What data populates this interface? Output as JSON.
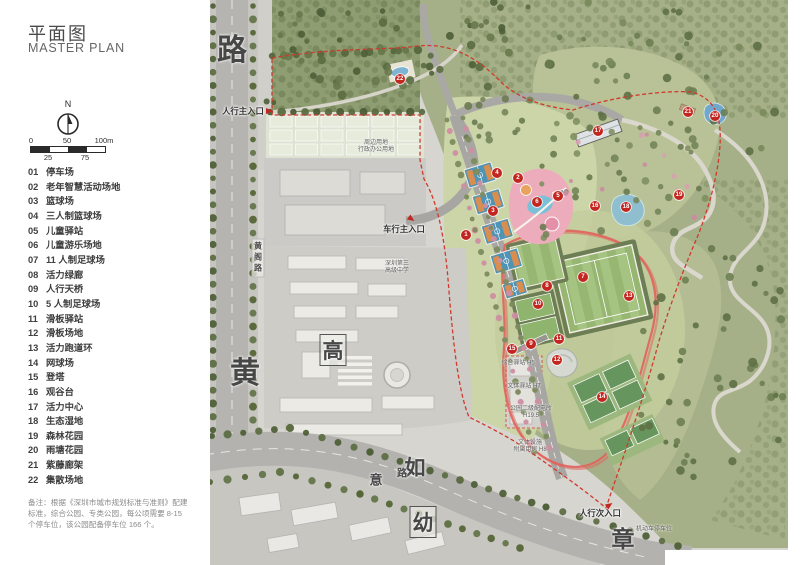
{
  "panel": {
    "title": "平面图",
    "subtitle": "MASTER PLAN",
    "compass": "N",
    "scale": {
      "top": [
        "0",
        "50",
        "100m"
      ],
      "bottom": [
        "25",
        "75"
      ]
    },
    "legend": [
      [
        "01",
        "停车场"
      ],
      [
        "02",
        "老年智慧活动场地"
      ],
      [
        "03",
        "篮球场"
      ],
      [
        "04",
        "三人制篮球场"
      ],
      [
        "05",
        "儿童驿站"
      ],
      [
        "06",
        "儿童游乐场地"
      ],
      [
        "07",
        "11 人制足球场"
      ],
      [
        "08",
        "活力绿廊"
      ],
      [
        "09",
        "人行天桥"
      ],
      [
        "10",
        "5 人制足球场"
      ],
      [
        "11",
        "滑板驿站"
      ],
      [
        "12",
        "滑板场地"
      ],
      [
        "13",
        "活力跑道环"
      ],
      [
        "14",
        "网球场"
      ],
      [
        "15",
        "登塔"
      ],
      [
        "16",
        "观谷台"
      ],
      [
        "17",
        "活力中心"
      ],
      [
        "18",
        "生态湿地"
      ],
      [
        "19",
        "森林花园"
      ],
      [
        "20",
        "雨塘花园"
      ],
      [
        "21",
        "紫藤廊架"
      ],
      [
        "22",
        "集散场地"
      ]
    ],
    "note_lines": [
      "备注：根据《深圳市城市规划标准与准则》配建",
      "标准，综合公园、专类公园，每公顷需要 8-15",
      "个停车位，该公园配备停车位 166 个。"
    ]
  },
  "map": {
    "markers": [
      {
        "n": "1",
        "x": 466,
        "y": 235
      },
      {
        "n": "2",
        "x": 518,
        "y": 178
      },
      {
        "n": "3",
        "x": 493,
        "y": 211
      },
      {
        "n": "4",
        "x": 497,
        "y": 173
      },
      {
        "n": "5",
        "x": 558,
        "y": 196
      },
      {
        "n": "6",
        "x": 537,
        "y": 202
      },
      {
        "n": "7",
        "x": 583,
        "y": 277
      },
      {
        "n": "8",
        "x": 547,
        "y": 286
      },
      {
        "n": "9",
        "x": 531,
        "y": 344
      },
      {
        "n": "10",
        "x": 538,
        "y": 304
      },
      {
        "n": "11",
        "x": 559,
        "y": 339
      },
      {
        "n": "12",
        "x": 557,
        "y": 360
      },
      {
        "n": "13",
        "x": 629,
        "y": 296
      },
      {
        "n": "14",
        "x": 602,
        "y": 397
      },
      {
        "n": "15",
        "x": 512,
        "y": 349
      },
      {
        "n": "16",
        "x": 595,
        "y": 206
      },
      {
        "n": "17",
        "x": 598,
        "y": 131
      },
      {
        "n": "18",
        "x": 626,
        "y": 207
      },
      {
        "n": "19",
        "x": 679,
        "y": 195
      },
      {
        "n": "20",
        "x": 715,
        "y": 116
      },
      {
        "n": "21",
        "x": 688,
        "y": 112
      },
      {
        "n": "22",
        "x": 400,
        "y": 79
      }
    ],
    "entrances": [
      {
        "label": "人行主入口",
        "x": 243,
        "y": 111,
        "tri_x": 269,
        "tri_y": 111,
        "rot": 0
      },
      {
        "label": "车行主入口",
        "x": 404,
        "y": 229,
        "tri_x": 411,
        "tri_y": 219,
        "rot": 35
      },
      {
        "label": "人行次入口",
        "x": 600,
        "y": 513,
        "tri_x": 609,
        "tri_y": 505,
        "rot": -35
      }
    ],
    "road_labels": [
      {
        "text": "路",
        "x": 232,
        "y": 47,
        "size": 30
      },
      {
        "text": "黄",
        "x": 245,
        "y": 370,
        "size": 30
      },
      {
        "text": "高",
        "x": 333,
        "y": 350,
        "size": 21,
        "boxed": true
      },
      {
        "text": "如",
        "x": 415,
        "y": 467,
        "size": 21
      },
      {
        "text": "意",
        "x": 376,
        "y": 479,
        "size": 13
      },
      {
        "text": "路",
        "x": 402,
        "y": 472,
        "size": 10
      },
      {
        "text": "幼",
        "x": 423,
        "y": 522,
        "size": 21,
        "boxed": true
      },
      {
        "text": "章",
        "x": 623,
        "y": 537,
        "size": 23
      },
      {
        "text": "黄阁路",
        "x": 258,
        "y": 258,
        "size": 8,
        "vertical": true
      }
    ],
    "facility_labels": [
      {
        "lines": [
          "周边用地",
          "行政办公用地"
        ],
        "x": 376,
        "y": 147
      },
      {
        "lines": [
          "深圳第三",
          "高级中学"
        ],
        "x": 397,
        "y": 268
      },
      {
        "lines": [
          "综合驿站 H5"
        ],
        "x": 518,
        "y": 364
      },
      {
        "lines": [
          "文体驿站 H7"
        ],
        "x": 524,
        "y": 387
      },
      {
        "lines": [
          "公园二级配电所",
          "H19.5"
        ],
        "x": 531,
        "y": 413
      },
      {
        "lines": [
          "文体设施",
          "附属用房 H8"
        ],
        "x": 530,
        "y": 447
      },
      {
        "lines": [
          "机动车停车位"
        ],
        "x": 654,
        "y": 530
      }
    ],
    "colors": {
      "marker_red": "#c3251f",
      "boundary_red": "#d0392b",
      "water_blue": "#7db4d2",
      "court_blue": "#4f93b5",
      "court_orange": "#d98e4f",
      "field_green": "#9cbb79",
      "track_pink": "#e0635c",
      "hill_green": "#a6b088",
      "urban_gray": "#c6c5c0"
    }
  }
}
